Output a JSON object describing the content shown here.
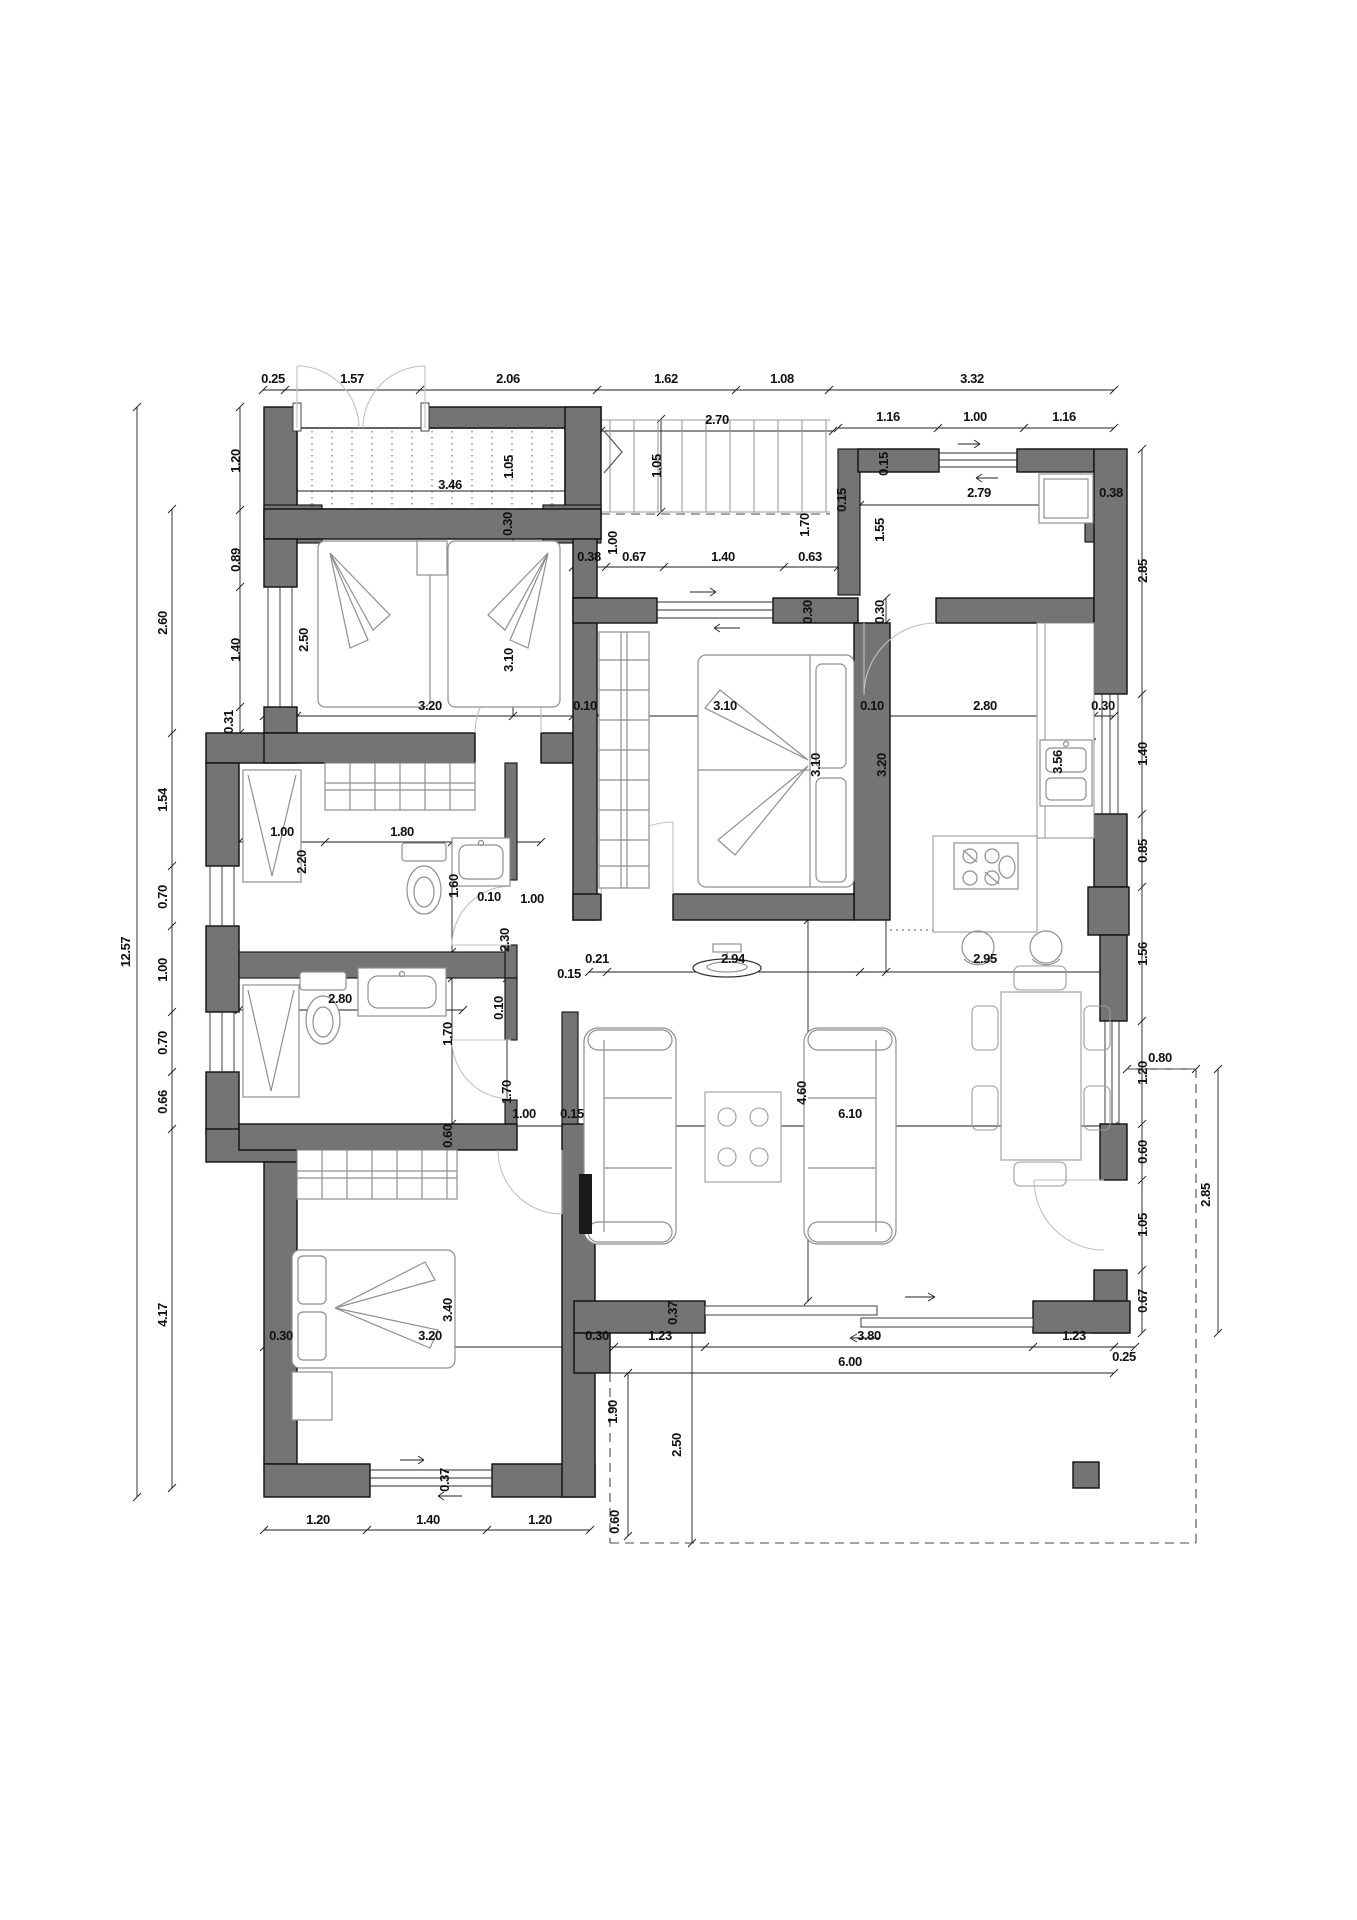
{
  "document": {
    "type": "architectural-floor-plan",
    "units": "meters",
    "sheet_background": "#ffffff"
  },
  "colors": {
    "wall_fill": "#747474",
    "wall_stroke": "#0f0f0f",
    "dimension_line": "#1c1c1c",
    "furniture_line": "#8f8f8f",
    "door_arc": "#c0c0c0",
    "dash_line": "#4a4a4a",
    "text": "#111111"
  },
  "dimensions": [
    {
      "label": "0.25",
      "x": 273,
      "y": 383,
      "rot": 0
    },
    {
      "label": "1.57",
      "x": 352,
      "y": 383,
      "rot": 0
    },
    {
      "label": "2.06",
      "x": 508,
      "y": 383,
      "rot": 0
    },
    {
      "label": "1.62",
      "x": 666,
      "y": 383,
      "rot": 0
    },
    {
      "label": "1.08",
      "x": 782,
      "y": 383,
      "rot": 0
    },
    {
      "label": "3.32",
      "x": 972,
      "y": 383,
      "rot": 0
    },
    {
      "label": "2.70",
      "x": 717,
      "y": 424,
      "rot": 0
    },
    {
      "label": "1.16",
      "x": 888,
      "y": 421,
      "rot": 0
    },
    {
      "label": "1.00",
      "x": 975,
      "y": 421,
      "rot": 0
    },
    {
      "label": "1.16",
      "x": 1064,
      "y": 421,
      "rot": 0
    },
    {
      "label": "1.20",
      "x": 240,
      "y": 461,
      "rot": 1
    },
    {
      "label": "0.89",
      "x": 240,
      "y": 560,
      "rot": 1
    },
    {
      "label": "1.40",
      "x": 240,
      "y": 650,
      "rot": 1
    },
    {
      "label": "0.31",
      "x": 233,
      "y": 722,
      "rot": 1
    },
    {
      "label": "12.57",
      "x": 130,
      "y": 952,
      "rot": 1
    },
    {
      "label": "2.60",
      "x": 167,
      "y": 623,
      "rot": 1
    },
    {
      "label": "1.54",
      "x": 167,
      "y": 800,
      "rot": 1
    },
    {
      "label": "0.70",
      "x": 167,
      "y": 897,
      "rot": 1
    },
    {
      "label": "1.00",
      "x": 167,
      "y": 970,
      "rot": 1
    },
    {
      "label": "0.70",
      "x": 167,
      "y": 1043,
      "rot": 1
    },
    {
      "label": "0.66",
      "x": 167,
      "y": 1102,
      "rot": 1
    },
    {
      "label": "4.17",
      "x": 167,
      "y": 1315,
      "rot": 1
    },
    {
      "label": "3.46",
      "x": 450,
      "y": 489,
      "rot": 0
    },
    {
      "label": "1.05",
      "x": 513,
      "y": 467,
      "rot": 1
    },
    {
      "label": "0.30",
      "x": 512,
      "y": 524,
      "rot": 1
    },
    {
      "label": "1.05",
      "x": 661,
      "y": 466,
      "rot": 1
    },
    {
      "label": "1.00",
      "x": 617,
      "y": 543,
      "rot": 1
    },
    {
      "label": "0.38",
      "x": 589,
      "y": 561,
      "rot": 0
    },
    {
      "label": "0.67",
      "x": 634,
      "y": 561,
      "rot": 0
    },
    {
      "label": "1.40",
      "x": 723,
      "y": 561,
      "rot": 0
    },
    {
      "label": "0.63",
      "x": 810,
      "y": 561,
      "rot": 0
    },
    {
      "label": "1.70",
      "x": 809,
      "y": 525,
      "rot": 1
    },
    {
      "label": "1.55",
      "x": 884,
      "y": 530,
      "rot": 1
    },
    {
      "label": "0.15",
      "x": 888,
      "y": 464,
      "rot": 1
    },
    {
      "label": "0.15",
      "x": 846,
      "y": 500,
      "rot": 1
    },
    {
      "label": "2.79",
      "x": 979,
      "y": 497,
      "rot": 0
    },
    {
      "label": "0.38",
      "x": 1111,
      "y": 497,
      "rot": 0
    },
    {
      "label": "0.30",
      "x": 812,
      "y": 612,
      "rot": 1
    },
    {
      "label": "0.30",
      "x": 884,
      "y": 612,
      "rot": 1
    },
    {
      "label": "2.85",
      "x": 1147,
      "y": 571,
      "rot": 1
    },
    {
      "label": "2.50",
      "x": 308,
      "y": 640,
      "rot": 1
    },
    {
      "label": "3.10",
      "x": 513,
      "y": 660,
      "rot": 1
    },
    {
      "label": "3.20",
      "x": 430,
      "y": 710,
      "rot": 0
    },
    {
      "label": "0.10",
      "x": 585,
      "y": 710,
      "rot": 0
    },
    {
      "label": "3.10",
      "x": 725,
      "y": 710,
      "rot": 0
    },
    {
      "label": "0.10",
      "x": 872,
      "y": 710,
      "rot": 0
    },
    {
      "label": "2.80",
      "x": 985,
      "y": 710,
      "rot": 0
    },
    {
      "label": "0.30",
      "x": 1103,
      "y": 710,
      "rot": 0
    },
    {
      "label": "3.10",
      "x": 820,
      "y": 765,
      "rot": 1
    },
    {
      "label": "3.20",
      "x": 886,
      "y": 765,
      "rot": 1
    },
    {
      "label": "3.56",
      "x": 1062,
      "y": 762,
      "rot": 1
    },
    {
      "label": "1.40",
      "x": 1147,
      "y": 754,
      "rot": 1
    },
    {
      "label": "0.85",
      "x": 1147,
      "y": 851,
      "rot": 1
    },
    {
      "label": "1.56",
      "x": 1147,
      "y": 954,
      "rot": 1
    },
    {
      "label": "1.20",
      "x": 1147,
      "y": 1073,
      "rot": 1
    },
    {
      "label": "0.60",
      "x": 1147,
      "y": 1152,
      "rot": 1
    },
    {
      "label": "1.05",
      "x": 1147,
      "y": 1225,
      "rot": 1
    },
    {
      "label": "0.67",
      "x": 1147,
      "y": 1301,
      "rot": 1
    },
    {
      "label": "0.80",
      "x": 1160,
      "y": 1062,
      "rot": 0
    },
    {
      "label": "2.85",
      "x": 1210,
      "y": 1195,
      "rot": 1
    },
    {
      "label": "1.00",
      "x": 282,
      "y": 836,
      "rot": 0
    },
    {
      "label": "1.80",
      "x": 402,
      "y": 836,
      "rot": 0
    },
    {
      "label": "2.20",
      "x": 306,
      "y": 862,
      "rot": 1
    },
    {
      "label": "1.60",
      "x": 458,
      "y": 886,
      "rot": 1
    },
    {
      "label": "0.10",
      "x": 489,
      "y": 901,
      "rot": 0
    },
    {
      "label": "1.00",
      "x": 532,
      "y": 903,
      "rot": 0
    },
    {
      "label": "2.30",
      "x": 509,
      "y": 940,
      "rot": 1
    },
    {
      "label": "2.80",
      "x": 340,
      "y": 1003,
      "rot": 0
    },
    {
      "label": "1.70",
      "x": 452,
      "y": 1034,
      "rot": 1
    },
    {
      "label": "0.10",
      "x": 503,
      "y": 1008,
      "rot": 1
    },
    {
      "label": "1.70",
      "x": 511,
      "y": 1092,
      "rot": 1
    },
    {
      "label": "0.60",
      "x": 452,
      "y": 1136,
      "rot": 1
    },
    {
      "label": "0.21",
      "x": 597,
      "y": 963,
      "rot": 0
    },
    {
      "label": "2.94",
      "x": 733,
      "y": 963,
      "rot": 0
    },
    {
      "label": "2.95",
      "x": 985,
      "y": 963,
      "rot": 0
    },
    {
      "label": "0.15",
      "x": 569,
      "y": 978,
      "rot": 0
    },
    {
      "label": "1.00",
      "x": 524,
      "y": 1118,
      "rot": 0
    },
    {
      "label": "0.15",
      "x": 572,
      "y": 1118,
      "rot": 0
    },
    {
      "label": "6.10",
      "x": 850,
      "y": 1118,
      "rot": 0
    },
    {
      "label": "4.60",
      "x": 806,
      "y": 1093,
      "rot": 1
    },
    {
      "label": "3.40",
      "x": 452,
      "y": 1310,
      "rot": 1
    },
    {
      "label": "3.20",
      "x": 430,
      "y": 1340,
      "rot": 0
    },
    {
      "label": "0.30",
      "x": 281,
      "y": 1340,
      "rot": 0
    },
    {
      "label": "0.30",
      "x": 597,
      "y": 1340,
      "rot": 0
    },
    {
      "label": "1.23",
      "x": 660,
      "y": 1340,
      "rot": 0
    },
    {
      "label": "3.80",
      "x": 869,
      "y": 1340,
      "rot": 0
    },
    {
      "label": "1.23",
      "x": 1074,
      "y": 1340,
      "rot": 0
    },
    {
      "label": "6.00",
      "x": 850,
      "y": 1366,
      "rot": 0
    },
    {
      "label": "0.25",
      "x": 1124,
      "y": 1361,
      "rot": 0
    },
    {
      "label": "0.37",
      "x": 677,
      "y": 1313,
      "rot": 1
    },
    {
      "label": "0.37",
      "x": 449,
      "y": 1480,
      "rot": 1
    },
    {
      "label": "1.20",
      "x": 318,
      "y": 1524,
      "rot": 0
    },
    {
      "label": "1.40",
      "x": 428,
      "y": 1524,
      "rot": 0
    },
    {
      "label": "1.20",
      "x": 540,
      "y": 1524,
      "rot": 0
    },
    {
      "label": "1.90",
      "x": 617,
      "y": 1412,
      "rot": 1
    },
    {
      "label": "2.50",
      "x": 681,
      "y": 1445,
      "rot": 1
    },
    {
      "label": "0.60",
      "x": 619,
      "y": 1522,
      "rot": 1
    }
  ]
}
